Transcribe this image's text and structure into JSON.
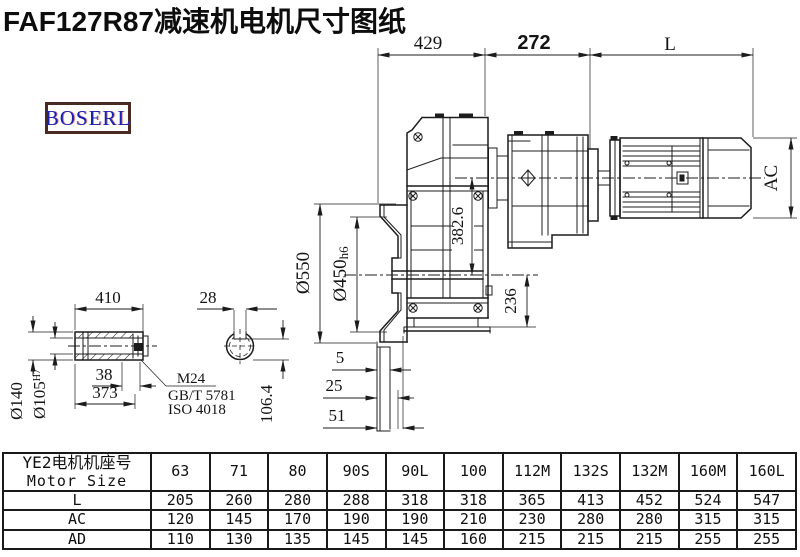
{
  "title": "FAF127R87减速机电机尺寸图纸",
  "logo": "BOSERL",
  "drawing": {
    "top_dims": {
      "gearbox_length": "429",
      "adapter_length": "272",
      "motor_length": "L"
    },
    "main_view": {
      "flange_diameter": "Ø550",
      "spigot_diameter": "Ø450",
      "spigot_tolerance": "h6",
      "axis_distance": "382.6",
      "center_to_base": "236",
      "motor_diameter": "AC",
      "offset_a": "5",
      "offset_b": "25",
      "offset_c": "51"
    },
    "shaft_view": {
      "shaft_length": "410",
      "outer_diameter": "Ø140",
      "bore_diameter": "Ø105",
      "bore_tolerance": "H7",
      "end_offset": "38",
      "bore_depth": "373",
      "key_width": "28",
      "key_depth": "106.4",
      "thread_note_1": "M24",
      "thread_note_2": "GB/T 5781",
      "thread_note_3": "ISO 4018"
    }
  },
  "table": {
    "header_line1": "YE2电机机座号",
    "header_line2": "Motor Size",
    "columns": [
      "63",
      "71",
      "80",
      "90S",
      "90L",
      "100",
      "112M",
      "132S",
      "132M",
      "160M",
      "160L"
    ],
    "rows": [
      {
        "label": "L",
        "values": [
          "205",
          "260",
          "280",
          "288",
          "318",
          "318",
          "365",
          "413",
          "452",
          "524",
          "547"
        ]
      },
      {
        "label": "AC",
        "values": [
          "120",
          "145",
          "170",
          "190",
          "190",
          "210",
          "230",
          "280",
          "280",
          "315",
          "315"
        ]
      },
      {
        "label": "AD",
        "values": [
          "110",
          "130",
          "135",
          "145",
          "145",
          "160",
          "215",
          "215",
          "215",
          "255",
          "255"
        ]
      }
    ]
  }
}
